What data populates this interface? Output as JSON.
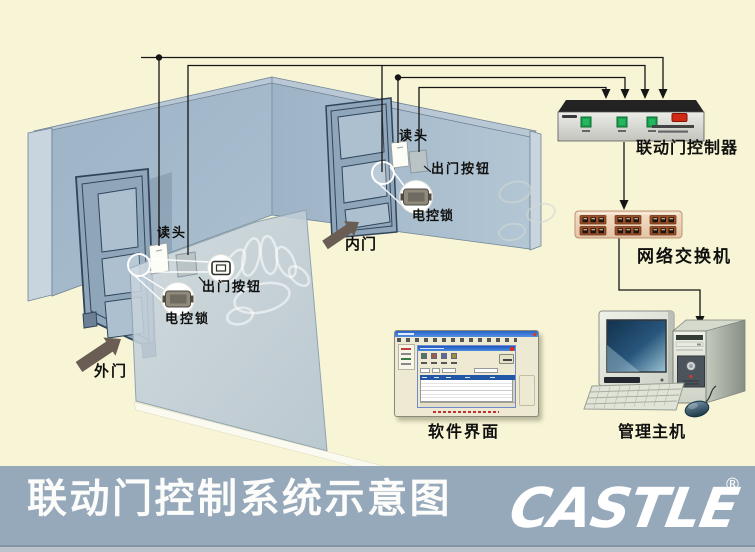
{
  "banner": {
    "title": "联动门控制系统示意图",
    "logo_text": "CASTLE",
    "registered_mark": "®"
  },
  "room": {
    "outer_door": {
      "door_label": "外门",
      "reader_label": "读头",
      "exit_button_label": "出门按钮",
      "lock_label": "电控锁"
    },
    "inner_door": {
      "door_label": "内门",
      "reader_label": "读头",
      "exit_button_label": "出门按钮",
      "lock_label": "电控锁"
    }
  },
  "equipment": {
    "controller_label": "联动门控制器",
    "switch_label": "网络交换机",
    "software_label": "软件界面",
    "host_label": "管理主机"
  },
  "colors": {
    "background": "#F8F5D6",
    "banner_bg": "#96A9BB",
    "wall": "#A5BACB",
    "partition": "#C2CFD8",
    "wire": "#151515",
    "controller_button_green": "#18A350",
    "controller_switch_red": "#D02A14",
    "switch_body": "#F2D8C0",
    "switch_port": "#9A4F28"
  }
}
